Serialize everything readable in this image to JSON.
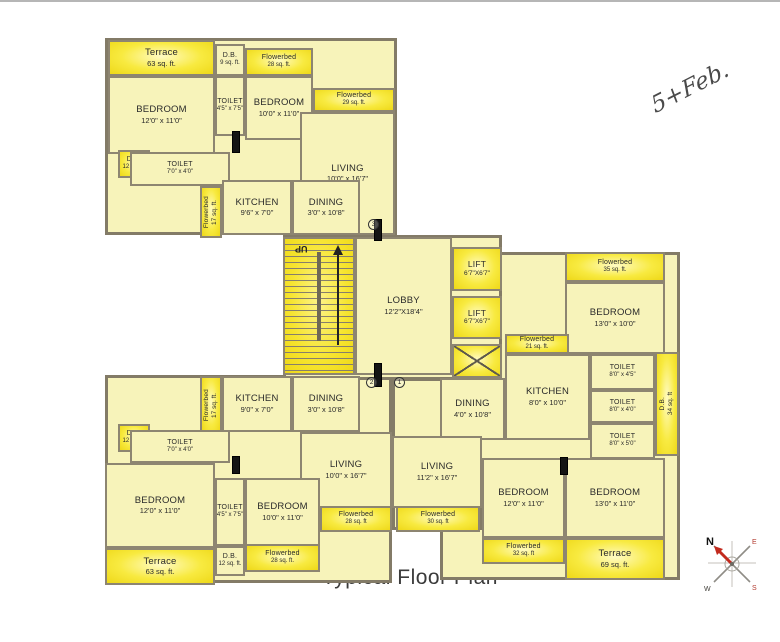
{
  "meta": {
    "title": "Typical Floor Plan",
    "handwritten_note": "5+Feb."
  },
  "colors": {
    "room_fill": "#f7f3ba",
    "highlight_yellow": "#f8ea40",
    "wall": "#8d8571",
    "compass_needle_red": "#c22a1e"
  },
  "compass": {
    "n": "N",
    "e": "E",
    "s": "S",
    "w": "W"
  },
  "stairs": {
    "up_label": "UP"
  },
  "door_numbers": [
    {
      "label": "2",
      "x": 366,
      "y": 377
    },
    {
      "label": "1",
      "x": 394,
      "y": 377
    },
    {
      "label": "3",
      "x": 368,
      "y": 219
    }
  ],
  "doors": [
    {
      "x": 232,
      "y": 131,
      "w": 8,
      "h": 22
    },
    {
      "x": 374,
      "y": 219,
      "w": 8,
      "h": 22
    },
    {
      "x": 374,
      "y": 363,
      "w": 8,
      "h": 24
    },
    {
      "x": 232,
      "y": 456,
      "w": 8,
      "h": 18
    },
    {
      "x": 560,
      "y": 457,
      "w": 8,
      "h": 18
    }
  ],
  "areas": [
    {
      "id": "unit-top-left-footprint",
      "type": "unit",
      "x": 105,
      "y": 38,
      "w": 292,
      "h": 197
    },
    {
      "id": "unit-bottom-left-footprint",
      "type": "unit",
      "x": 105,
      "y": 375,
      "w": 287,
      "h": 208
    },
    {
      "id": "unit-right-footprint",
      "type": "unit",
      "x": 440,
      "y": 252,
      "w": 240,
      "h": 328
    },
    {
      "id": "unit-right-living-wing",
      "type": "unit",
      "x": 392,
      "y": 378,
      "w": 90,
      "h": 152
    },
    {
      "id": "core-footprint",
      "type": "unit",
      "x": 283,
      "y": 235,
      "w": 219,
      "h": 145
    },
    {
      "id": "terrace-top-left",
      "type": "bright",
      "x": 108,
      "y": 40,
      "w": 107,
      "h": 36,
      "label": "Terrace",
      "sub": "63 sq. ft."
    },
    {
      "id": "db-top-left-upper",
      "type": "room",
      "x": 215,
      "y": 44,
      "w": 30,
      "h": 32,
      "label": "D.B.",
      "sub": "9 sq. ft.",
      "small": true
    },
    {
      "id": "flowerbed-top-left",
      "type": "bright",
      "x": 245,
      "y": 48,
      "w": 68,
      "h": 28,
      "label": "Flowerbed",
      "sub": "28 sq. ft.",
      "small": true
    },
    {
      "id": "flowerbed-top-living",
      "type": "bright",
      "x": 313,
      "y": 88,
      "w": 82,
      "h": 24,
      "label": "Flowerbed",
      "sub": "29 sq. ft.",
      "small": true
    },
    {
      "id": "bedroom-tl-1",
      "type": "room",
      "x": 108,
      "y": 76,
      "w": 107,
      "h": 78,
      "label": "BEDROOM",
      "sub": "12'0\" x 11'0\""
    },
    {
      "id": "toilet-tl-1",
      "type": "room",
      "x": 215,
      "y": 76,
      "w": 30,
      "h": 60,
      "label": "TOILET",
      "sub": "4'5\" x 7'5\"",
      "small": true
    },
    {
      "id": "bedroom-tl-2",
      "type": "room",
      "x": 245,
      "y": 76,
      "w": 68,
      "h": 64,
      "label": "BEDROOM",
      "sub": "10'0\" x 11'0\""
    },
    {
      "id": "living-tl",
      "type": "room",
      "x": 300,
      "y": 112,
      "w": 95,
      "h": 123,
      "label": "LIVING",
      "sub": "10'0\" x 16'7\""
    },
    {
      "id": "db-tl-toilet",
      "type": "bright",
      "x": 118,
      "y": 150,
      "w": 32,
      "h": 28,
      "label": "D.B.",
      "sub": "12 sq. ft.",
      "small": true
    },
    {
      "id": "toilet-tl-2",
      "type": "room",
      "x": 130,
      "y": 152,
      "w": 100,
      "h": 34,
      "label": "TOILET",
      "sub": "7'0\" x 4'0\"",
      "small": true
    },
    {
      "id": "flowerbed-tl-side",
      "type": "brightV",
      "x": 200,
      "y": 186,
      "w": 22,
      "h": 52,
      "label": "Flowerbed",
      "sub": "17 sq. ft."
    },
    {
      "id": "kitchen-tl",
      "type": "room",
      "x": 222,
      "y": 180,
      "w": 70,
      "h": 55,
      "label": "KITCHEN",
      "sub": "9'6\" x 7'0\""
    },
    {
      "id": "dining-tl",
      "type": "room",
      "x": 292,
      "y": 180,
      "w": 68,
      "h": 55,
      "label": "DINING",
      "sub": "3'0\" x 10'8\""
    },
    {
      "id": "staircase",
      "type": "stair",
      "x": 283,
      "y": 237,
      "w": 72,
      "h": 138
    },
    {
      "id": "lobby",
      "type": "room",
      "x": 355,
      "y": 237,
      "w": 97,
      "h": 138,
      "label": "LOBBY",
      "sub": "12'2\"X18'4\""
    },
    {
      "id": "lift-1",
      "type": "lift",
      "x": 452,
      "y": 247,
      "w": 50,
      "h": 44,
      "label": "LIFT",
      "sub": "6'7\"X6'7\""
    },
    {
      "id": "lift-2",
      "type": "lift",
      "x": 452,
      "y": 296,
      "w": 50,
      "h": 43,
      "label": "LIFT",
      "sub": "6'7\"X6'7\""
    },
    {
      "id": "duct-shaft",
      "type": "shaft",
      "x": 452,
      "y": 344,
      "w": 50,
      "h": 34
    },
    {
      "id": "flowerbed-right-top",
      "type": "bright",
      "x": 565,
      "y": 252,
      "w": 100,
      "h": 30,
      "label": "Flowerbed",
      "sub": "35 sq. ft.",
      "small": true
    },
    {
      "id": "bedroom-right-top",
      "type": "room",
      "x": 565,
      "y": 282,
      "w": 100,
      "h": 72,
      "label": "BEDROOM",
      "sub": "13'0\" x 10'0\""
    },
    {
      "id": "flowerbed-right-kitchen",
      "type": "bright",
      "x": 505,
      "y": 334,
      "w": 64,
      "h": 20,
      "label": "Flowerbed",
      "sub": "21 sq. ft.",
      "small": true
    },
    {
      "id": "kitchen-right",
      "type": "room",
      "x": 505,
      "y": 354,
      "w": 85,
      "h": 86,
      "label": "KITCHEN",
      "sub": "8'0\" x 10'0\""
    },
    {
      "id": "dining-right",
      "type": "room",
      "x": 440,
      "y": 378,
      "w": 65,
      "h": 62,
      "label": "DINING",
      "sub": "4'0\" x 10'8\""
    },
    {
      "id": "toilet-right-1",
      "type": "room",
      "x": 590,
      "y": 354,
      "w": 65,
      "h": 36,
      "label": "TOILET",
      "sub": "8'0\" x 4'5\"",
      "small": true
    },
    {
      "id": "toilet-right-2",
      "type": "room",
      "x": 590,
      "y": 390,
      "w": 65,
      "h": 33,
      "label": "TOILET",
      "sub": "8'0\" x 4'0\"",
      "small": true
    },
    {
      "id": "toilet-right-3",
      "type": "room",
      "x": 590,
      "y": 423,
      "w": 65,
      "h": 36,
      "label": "TOILET",
      "sub": "8'0\" x 5'0\"",
      "small": true
    },
    {
      "id": "db-right",
      "type": "brightV",
      "x": 655,
      "y": 352,
      "w": 24,
      "h": 104,
      "label": "D.B.",
      "sub": "34 sq. ft"
    },
    {
      "id": "living-right",
      "type": "room",
      "x": 392,
      "y": 436,
      "w": 90,
      "h": 72,
      "label": "LIVING",
      "sub": "11'2\" x 16'7\""
    },
    {
      "id": "bedroom-bottom-right-1",
      "type": "room",
      "x": 482,
      "y": 458,
      "w": 83,
      "h": 80,
      "label": "BEDROOM",
      "sub": "12'0\" x 11'0\""
    },
    {
      "id": "bedroom-bottom-right-2",
      "type": "room",
      "x": 565,
      "y": 458,
      "w": 100,
      "h": 80,
      "label": "BEDROOM",
      "sub": "13'0\" x 11'0\""
    },
    {
      "id": "flowerbed-bottom-right",
      "type": "bright",
      "x": 482,
      "y": 538,
      "w": 83,
      "h": 26,
      "label": "Flowerbed",
      "sub": "32 sq. ft",
      "small": true
    },
    {
      "id": "terrace-bottom-right",
      "type": "bright",
      "x": 565,
      "y": 538,
      "w": 100,
      "h": 42,
      "label": "Terrace",
      "sub": "69 sq. ft."
    },
    {
      "id": "flowerbed-bl-side",
      "type": "brightV",
      "x": 200,
      "y": 376,
      "w": 22,
      "h": 58,
      "label": "Flowerbed",
      "sub": "17 sq. ft."
    },
    {
      "id": "kitchen-bl",
      "type": "room",
      "x": 222,
      "y": 376,
      "w": 70,
      "h": 56,
      "label": "KITCHEN",
      "sub": "9'0\" x 7'0\""
    },
    {
      "id": "dining-bl",
      "type": "room",
      "x": 292,
      "y": 376,
      "w": 68,
      "h": 56,
      "label": "DINING",
      "sub": "3'0\" x 10'8\""
    },
    {
      "id": "living-bl",
      "type": "room",
      "x": 300,
      "y": 432,
      "w": 92,
      "h": 76,
      "label": "LIVING",
      "sub": "10'0\" x 16'7\""
    },
    {
      "id": "db-bl-toilet",
      "type": "bright",
      "x": 118,
      "y": 424,
      "w": 32,
      "h": 28,
      "label": "D.B.",
      "sub": "12 sq. ft.",
      "small": true
    },
    {
      "id": "toilet-bl-2",
      "type": "room",
      "x": 130,
      "y": 430,
      "w": 100,
      "h": 33,
      "label": "TOILET",
      "sub": "7'0\" x 4'0\"",
      "small": true
    },
    {
      "id": "bedroom-bl-1",
      "type": "room",
      "x": 105,
      "y": 463,
      "w": 110,
      "h": 85,
      "label": "BEDROOM",
      "sub": "12'0\" x 11'0\""
    },
    {
      "id": "toilet-bl-1",
      "type": "room",
      "x": 215,
      "y": 478,
      "w": 30,
      "h": 68,
      "label": "TOILET",
      "sub": "4'5\" x 7'5\"",
      "small": true
    },
    {
      "id": "bedroom-bl-2",
      "type": "room",
      "x": 245,
      "y": 478,
      "w": 75,
      "h": 68,
      "label": "BEDROOM",
      "sub": "10'0\" x 11'0\""
    },
    {
      "id": "terrace-bottom-left",
      "type": "bright",
      "x": 105,
      "y": 548,
      "w": 110,
      "h": 37,
      "label": "Terrace",
      "sub": "63 sq. ft."
    },
    {
      "id": "db-bl-terrace",
      "type": "room",
      "x": 215,
      "y": 546,
      "w": 30,
      "h": 30,
      "label": "D.B.",
      "sub": "12 sq. ft.",
      "small": true
    },
    {
      "id": "flowerbed-bl-bottom",
      "type": "bright",
      "x": 245,
      "y": 544,
      "w": 75,
      "h": 28,
      "label": "Flowerbed",
      "sub": "28 sq. ft.",
      "small": true
    },
    {
      "id": "flowerbed-bottom-mid-left",
      "type": "bright",
      "x": 320,
      "y": 506,
      "w": 72,
      "h": 26,
      "label": "Flowerbed",
      "sub": "28 sq. ft",
      "small": true
    },
    {
      "id": "flowerbed-bottom-mid-right",
      "type": "bright",
      "x": 396,
      "y": 506,
      "w": 84,
      "h": 26,
      "label": "Flowerbed",
      "sub": "30 sq. ft",
      "small": true
    }
  ]
}
